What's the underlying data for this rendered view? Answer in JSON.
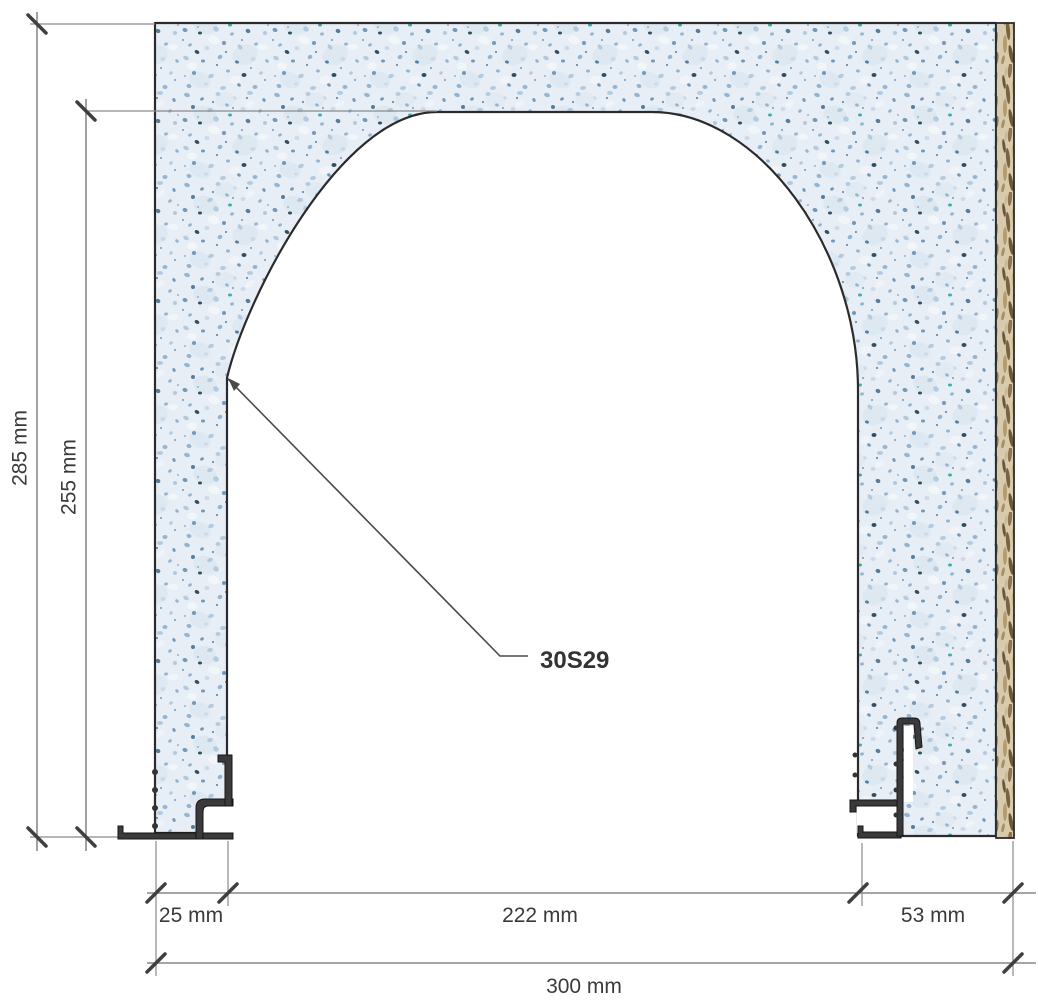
{
  "drawing": {
    "type": "technical-section-drawing",
    "product_label": "30S29",
    "dimensions": {
      "overall_height": "285 mm",
      "opening_height": "255 mm",
      "left_jamb_width": "25 mm",
      "opening_width": "222 mm",
      "right_jamb_width": "53 mm",
      "overall_width": "300 mm"
    },
    "colors": {
      "background": "#ffffff",
      "panel_base": "#e7eef5",
      "panel_outline": "#2b2b2b",
      "osb_base": "#d8cbad",
      "metal_profile": "#3a3a3a",
      "dimension_line": "#6f6f6f",
      "extension_line": "#8a8a8a",
      "tick": "#3f3f3f",
      "text": "#3a3a3a",
      "leader": "#4a4a4a"
    }
  }
}
